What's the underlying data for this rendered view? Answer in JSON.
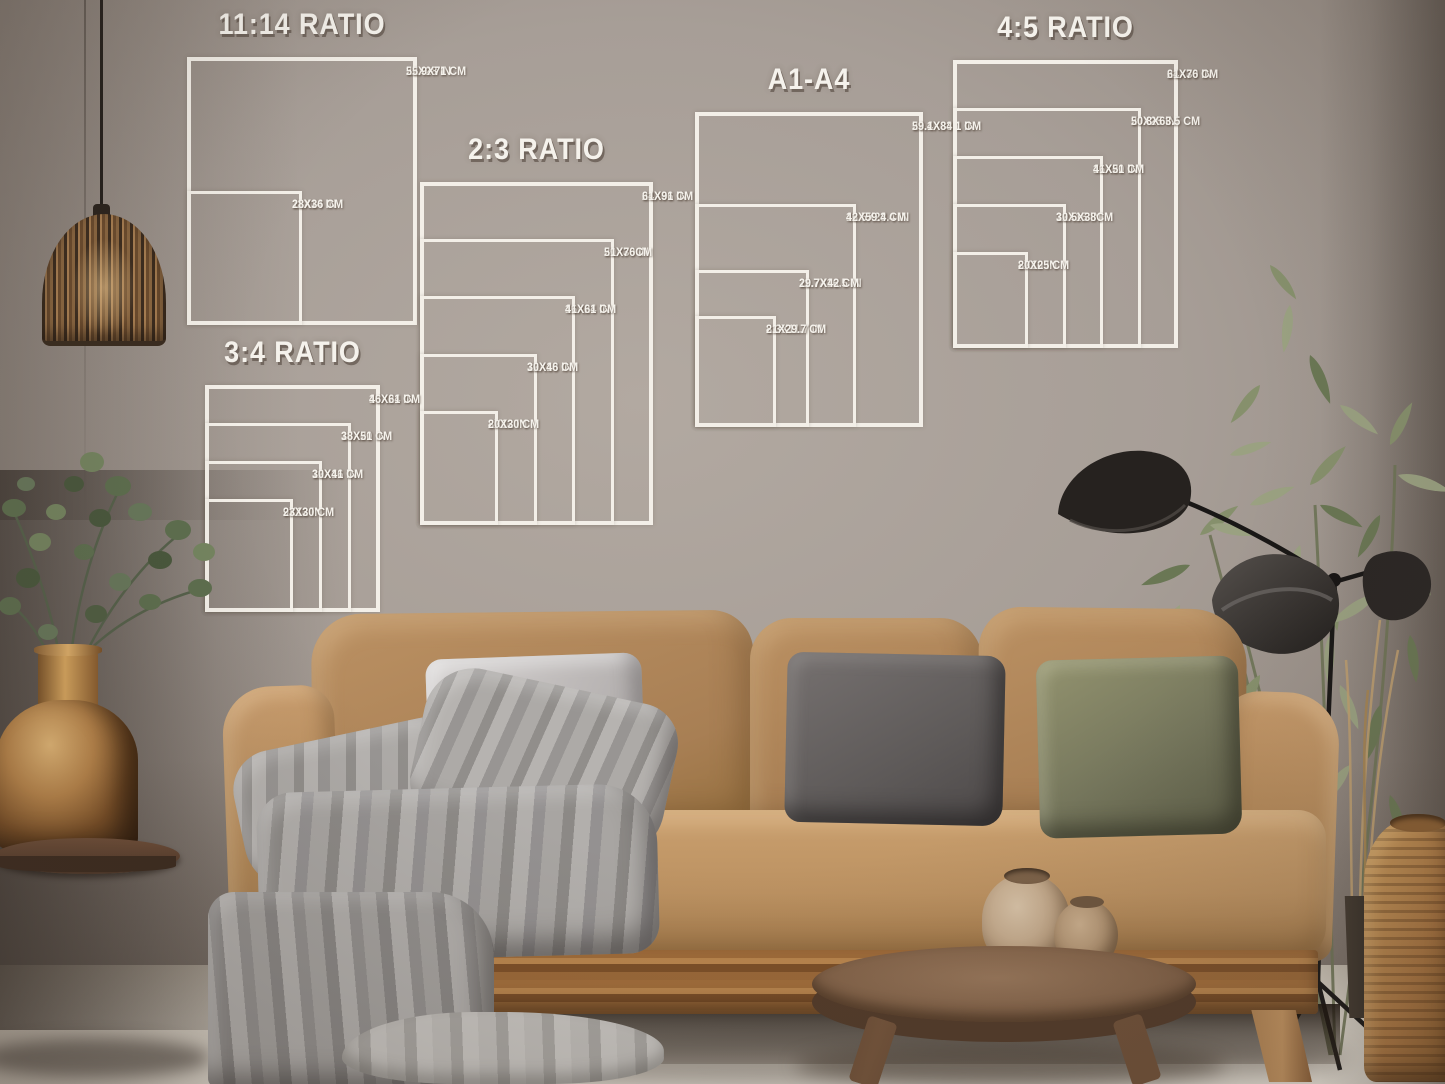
{
  "overlay": {
    "line_color": "#f3efe8",
    "text_color": "#f5f2ec"
  },
  "size_charts": [
    {
      "id": "ratio-11-14",
      "title": "11:14 RATIO",
      "sizes": [
        {
          "w": 22,
          "h": 28,
          "in": "22X28 IN",
          "cm": "55.9X71 CM"
        },
        {
          "w": 11,
          "h": 14,
          "in": "11X14 IN",
          "cm": "28X36 CM"
        }
      ]
    },
    {
      "id": "ratio-2-3",
      "title": "2:3 RATIO",
      "sizes": [
        {
          "w": 24,
          "h": 36,
          "in": "24X36 IN",
          "cm": "61X91 CM"
        },
        {
          "w": 20,
          "h": 30,
          "in": "20X30 IN",
          "cm": "51X76CM"
        },
        {
          "w": 16,
          "h": 24,
          "in": "16X24 IN",
          "cm": "41X61 CM"
        },
        {
          "w": 12,
          "h": 18,
          "in": "12X18 IN",
          "cm": "30X46 CM"
        },
        {
          "w": 8,
          "h": 12,
          "in": "8X12 IN",
          "cm": "20X30 CM"
        }
      ]
    },
    {
      "id": "ratio-3-4",
      "title": "3:4 RATIO",
      "sizes": [
        {
          "w": 18,
          "h": 24,
          "in": "18X24 IN",
          "cm": "46X61 CM"
        },
        {
          "w": 15,
          "h": 20,
          "in": "15X20 IN",
          "cm": "38X51 CM"
        },
        {
          "w": 12,
          "h": 16,
          "in": "12X16 IN",
          "cm": "30X41 CM"
        },
        {
          "w": 9,
          "h": 12,
          "in": "9X12 IN",
          "cm": "23X30 CM"
        }
      ]
    },
    {
      "id": "a1-a4",
      "title": "A1-A4",
      "sizes": [
        {
          "w": 23.4,
          "h": 33.1,
          "in": "23.4X33.1 IN",
          "cm": "59.1X84.1 CM"
        },
        {
          "w": 16.5,
          "h": 23.4,
          "in": "16.5X23.4 IN",
          "cm": "42X59.4 CM"
        },
        {
          "w": 11.7,
          "h": 16.5,
          "in": "11.7X16.5 IN",
          "cm": "29.7X42 CM"
        },
        {
          "w": 8.3,
          "h": 11.7,
          "in": "8.3X11.7 IN",
          "cm": "21X29.7 CM"
        }
      ]
    },
    {
      "id": "ratio-4-5",
      "title": "4:5 RATIO",
      "sizes": [
        {
          "w": 24,
          "h": 30,
          "in": "24X30 IN",
          "cm": "61X76 CM"
        },
        {
          "w": 20,
          "h": 25,
          "in": "20X25 IN",
          "cm": "50.8X63.5 CM"
        },
        {
          "w": 16,
          "h": 20,
          "in": "16X20 IN",
          "cm": "41X51 CM"
        },
        {
          "w": 12,
          "h": 15,
          "in": "12X15 IN",
          "cm": "30.5X38CM"
        },
        {
          "w": 8,
          "h": 10,
          "in": "8X10 IN",
          "cm": "20X25 CM"
        }
      ]
    }
  ]
}
